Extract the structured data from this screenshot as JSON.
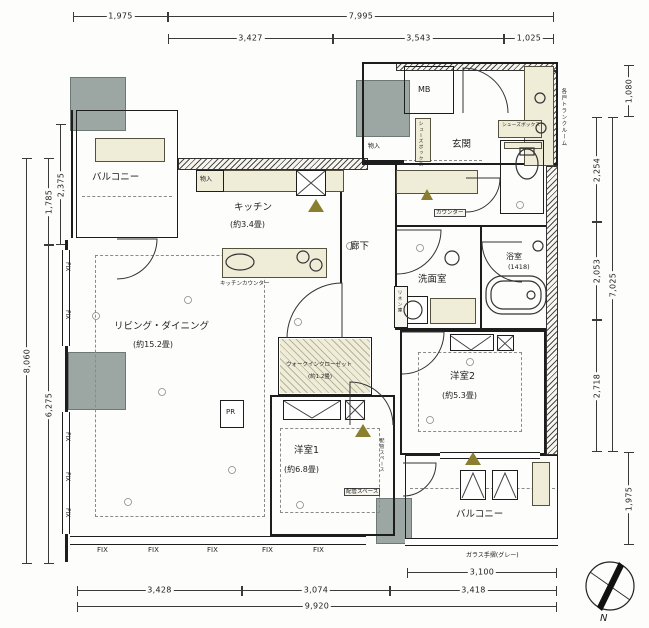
{
  "plan": {
    "north_label": "N",
    "rooms": {
      "balcony_top": "バルコニー",
      "kitchen_name": "キッチン",
      "kitchen_size": "(約3.4畳)",
      "entrance": "玄関",
      "mb": "MB",
      "corridor": "廊下",
      "washroom": "洗面室",
      "bath_name": "浴室",
      "bath_size": "(1418)",
      "ld_name": "リビング・ダイニング",
      "ld_size": "(約15.2畳)",
      "wic_name": "ウォークインクローゼット",
      "wic_size": "(約1.2畳)",
      "bed1_name": "洋室1",
      "bed1_size": "(約6.8畳)",
      "bed2_name": "洋室2",
      "bed2_size": "(約5.3畳)",
      "balcony_bottom": "バルコニー",
      "trunk": "各戸トランクルーム"
    },
    "labels": {
      "storage": "物入",
      "kitchen_counter": "キッチンカウンター",
      "shoe_box": "シューズボックス",
      "linen": "リネン庫",
      "counter": "カウンター",
      "pr": "PR",
      "pipe_space": "配管スペース",
      "glass_rail": "ガラス手摺(グレー)",
      "fix": "FIX"
    },
    "dims": {
      "top_left": "1,975",
      "top_total": "7,995",
      "top_a": "3,427",
      "top_b": "3,543",
      "top_c": "1,025",
      "left_total": "8,060",
      "left_upper": "1,785",
      "left_lower": "6,275",
      "left_inner": "2,375",
      "right_top": "1,080",
      "right_total": "7,025",
      "right_a": "2,254",
      "right_b": "2,053",
      "right_c": "2,718",
      "right_bottom": "1,975",
      "bottom_balcony": "3,100",
      "bottom_a": "3,428",
      "bottom_b": "3,074",
      "bottom_c": "3,418",
      "bottom_total": "9,920"
    },
    "colors": {
      "structure_gray": "#9ca7a4",
      "fixture_cream": "#efecd8",
      "marker_olive": "#8b7f2f",
      "line": "#1d1d1d"
    }
  }
}
